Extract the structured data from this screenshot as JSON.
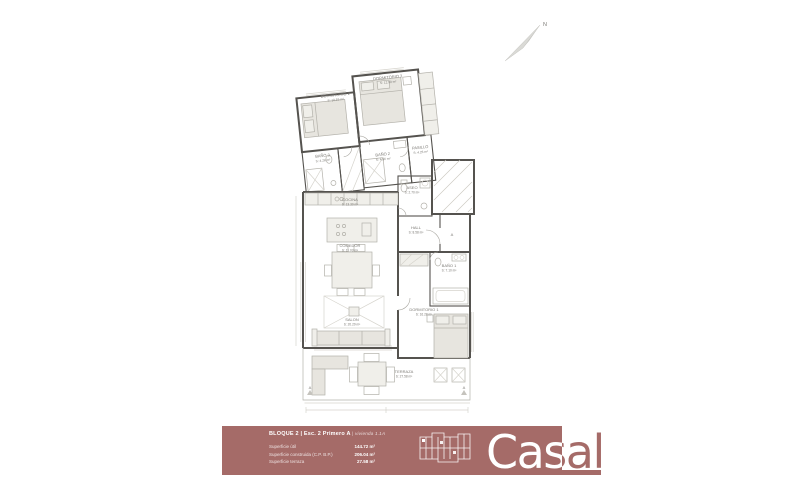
{
  "plan": {
    "rooms": [
      {
        "name": "DORMITORIO 2",
        "area": "S: 10.55 m²"
      },
      {
        "name": "DORMITORIO 3",
        "area": "S: 12.90 m²"
      },
      {
        "name": "BAÑO 3",
        "area": "S: 4.26 m²"
      },
      {
        "name": "BAÑO 2",
        "area": "S: 4.56 m²"
      },
      {
        "name": "PASILLO",
        "area": "S: 4.26 m²"
      },
      {
        "name": "COCINA",
        "area": "S: 13.30 m²"
      },
      {
        "name": "ASEO",
        "area": "S: 2.70 m²"
      },
      {
        "name": "HALL",
        "area": "S: 8.58 m²"
      },
      {
        "name": "COMEDOR",
        "area": "S: 11.03 m²"
      },
      {
        "name": "BAÑO 1",
        "area": "S: 7.10 m²"
      },
      {
        "name": "SALON",
        "area": "S: 20.29 m²"
      },
      {
        "name": "DORMITORIO 1",
        "area": "S: 16.28 m²"
      },
      {
        "name": "TERRAZA",
        "area": "S: 27.58 m²"
      }
    ],
    "entrance_label": "A",
    "section_label": "A",
    "north_label": "N"
  },
  "footer": {
    "title_bold": "BLOQUE 2 | Esc. 2 Primero A",
    "title_light": "| vivienda 1.1A",
    "rows": [
      {
        "label": "Superficie útil",
        "value": "144.72 m²"
      },
      {
        "label": "Superficie construida (C.P. B.P.)",
        "value": "206.04 m²"
      },
      {
        "label": "Superficie terraza",
        "value": "27.58 m²"
      }
    ],
    "logo": "Casal",
    "bar_color": "#a56b68"
  }
}
